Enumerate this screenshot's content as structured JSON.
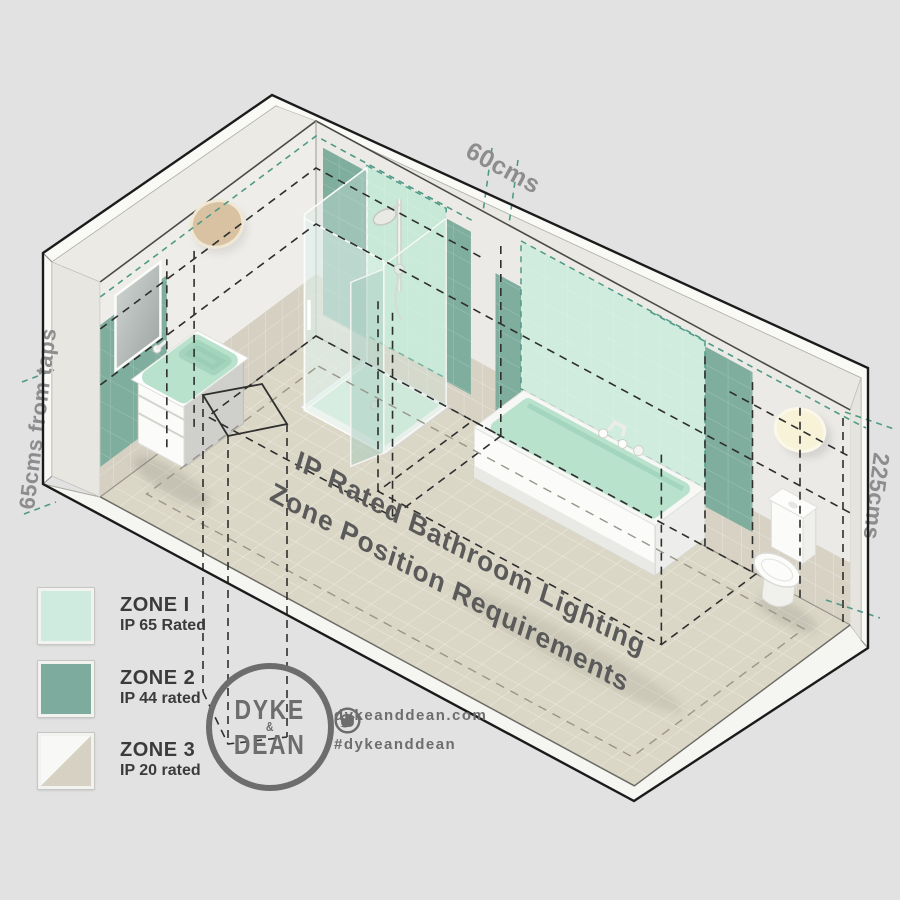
{
  "diagram_title": {
    "line1": "IP Rated Bathroom Lighting",
    "line2": "Zone Position Requirements"
  },
  "dimension_labels": {
    "top": "60cms",
    "left": "65cms from taps",
    "right": "225cms"
  },
  "legend": {
    "items": [
      {
        "zone_label": "ZONE I",
        "rating_label": "IP 65 Rated",
        "swatch_style": "solid",
        "swatch_color": "#cfeadf"
      },
      {
        "zone_label": "ZONE 2",
        "rating_label": "IP 44 rated",
        "swatch_style": "solid",
        "swatch_color": "#7dab9e"
      },
      {
        "zone_label": "ZONE 3",
        "rating_label": "IP 20 rated",
        "swatch_style": "diagonal-split",
        "swatch_color": "#d6d1c3",
        "swatch_color_secondary": "#f8f8f6"
      }
    ]
  },
  "brand": {
    "logo_line1": "DYKE",
    "logo_line2": "&",
    "logo_line3": "DEAN",
    "website": "dykeanddean.com",
    "hashtag": "#dykeanddean",
    "social": [
      {
        "name": "instagram-icon"
      },
      {
        "name": "twitter-icon"
      },
      {
        "name": "facebook-icon"
      },
      {
        "name": "pinterest-icon"
      }
    ]
  },
  "colors": {
    "background": "#e2e2e2",
    "zone1_mint": "#c8e9d8",
    "zone1_mint_light": "#cfecdf",
    "zone2_green": "#7fae9f",
    "zone3_beige": "#d6d1c3",
    "teal_dash": "#4f9a87",
    "black_dash": "#2e2e2e",
    "dim_text": "#8d8d8d",
    "floor_title_text": "#5a5a5a",
    "brand_gray": "#6d6d6d"
  }
}
